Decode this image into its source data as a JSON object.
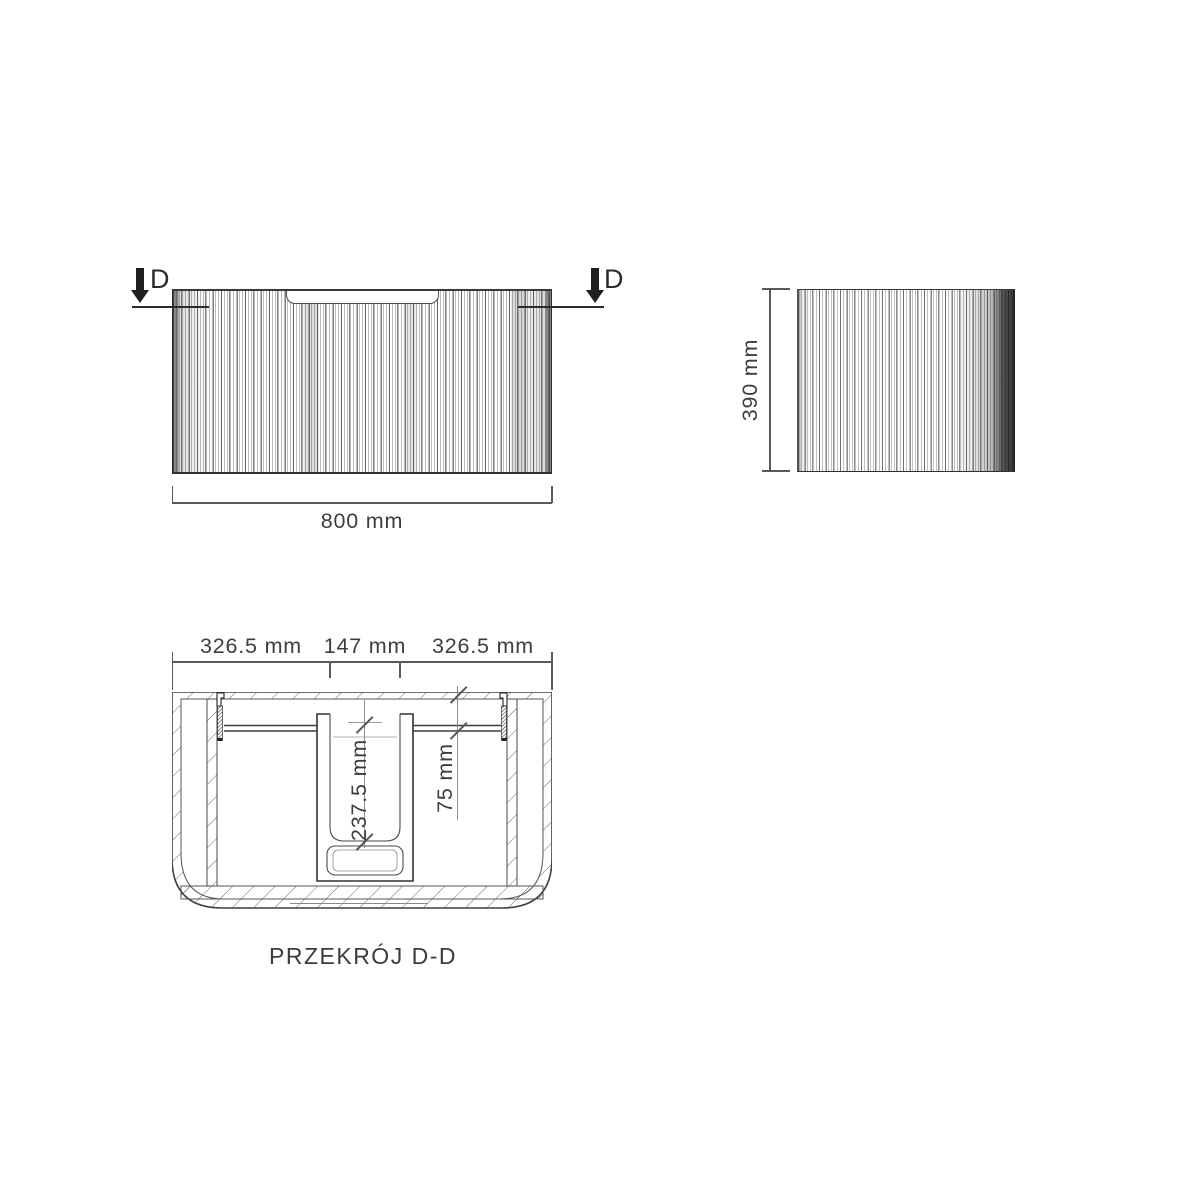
{
  "colors": {
    "line": "#3f3f3f",
    "dim_line": "#8f8f8f",
    "text": "#3d3d3d",
    "marker": "#1f1f1f",
    "background": "#ffffff"
  },
  "front_view": {
    "width_dim": "800 mm",
    "cut_label": "D"
  },
  "side_view": {
    "height_dim": "390 mm"
  },
  "section": {
    "title": "PRZEKRÓJ D-D",
    "top_dims": [
      "326.5 mm",
      "147 mm",
      "326.5 mm"
    ],
    "inner_depth_dim": "237.5 mm",
    "top_offset_dim": "75 mm"
  }
}
